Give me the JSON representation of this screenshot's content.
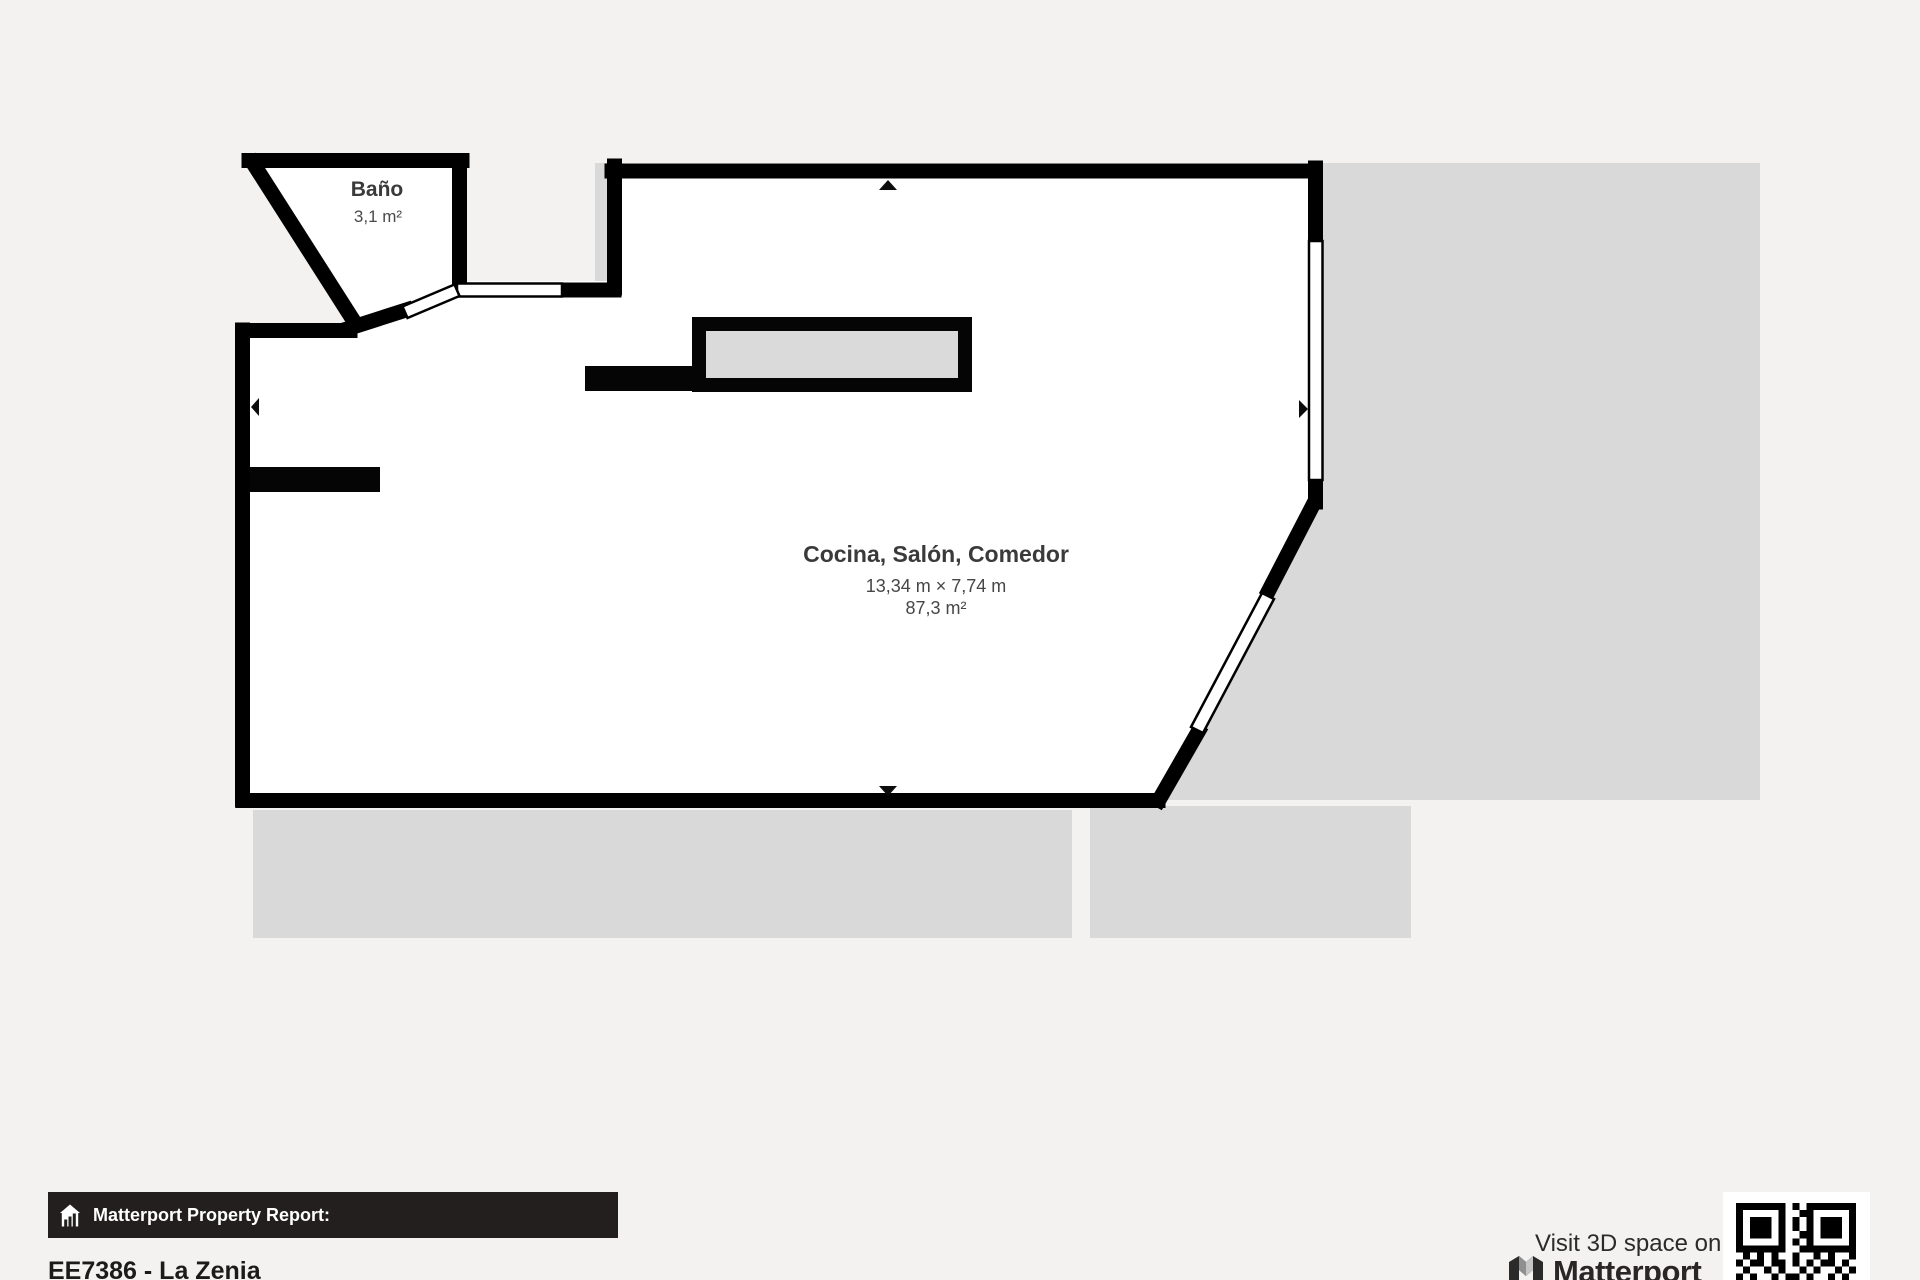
{
  "floorplan": {
    "rooms": [
      {
        "name": "Baño",
        "area": "3,1 m²"
      },
      {
        "name": "Cocina, Salón, Comedor",
        "dimensions": "13,34 m × 7,74 m",
        "area": "87,3 m²"
      }
    ]
  },
  "footer": {
    "report_label": "Matterport Property Report:",
    "property_title": "EE7386 - La Zenia",
    "visit_text": "Visit 3D space on",
    "brand_name": "Matterport"
  },
  "icons": {
    "report_bar": "house-icon",
    "brand": "matterport-logo",
    "qr": "qr-code"
  },
  "colors": {
    "background": "#f3f2f0",
    "terrace": "#d9d9d9",
    "wall": "#000000",
    "room_fill": "#ffffff",
    "bar_background": "#231f1f",
    "bar_text": "#ffffff",
    "label_text": "#3a3a3a"
  }
}
